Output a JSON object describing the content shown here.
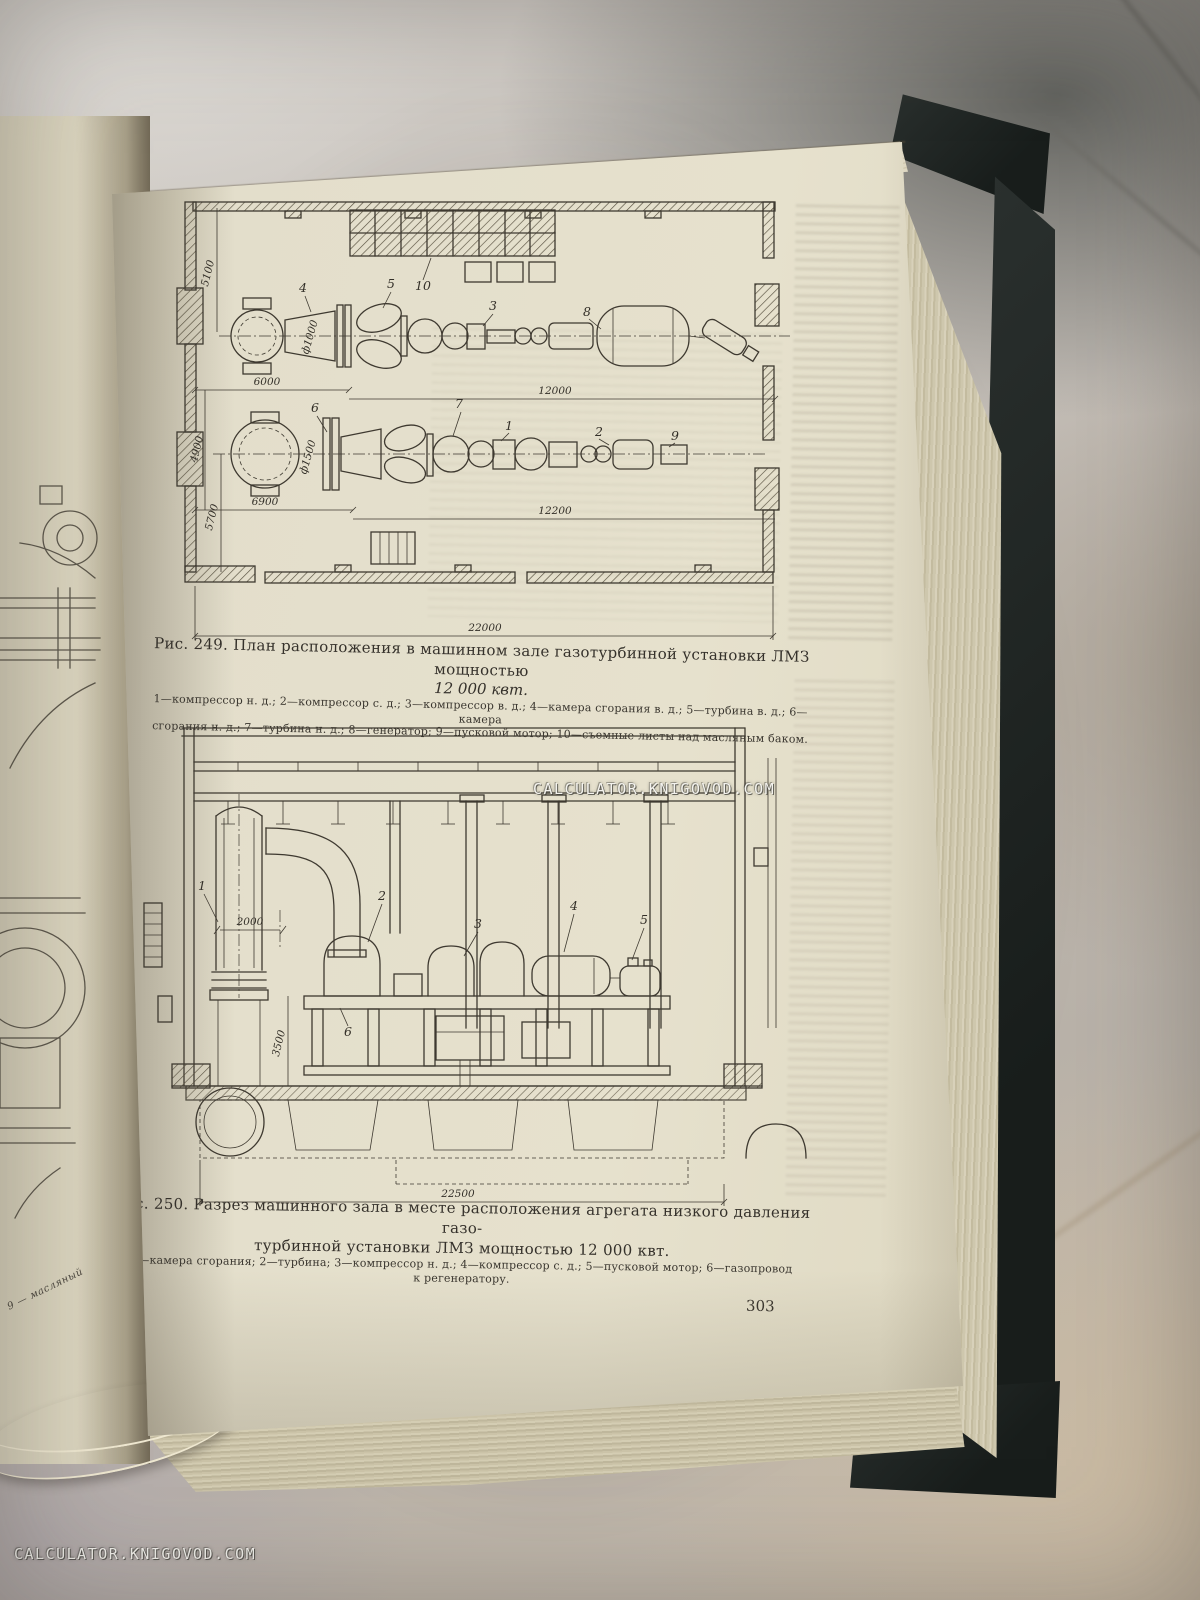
{
  "watermark": {
    "text": "CALCULATOR.KNIGOVOD.COM"
  },
  "page": {
    "number": "303"
  },
  "left_page": {
    "fragment_note": "9 — масляный"
  },
  "figure249": {
    "caption_line1": "Рис. 249. План расположения в машинном зале газотурбинной установки ЛМЗ мощностью",
    "caption_line2": "12 000 квт.",
    "legend_line1": "1—компрессор н. д.; 2—компрессор с. д.; 3—компрессор в. д.; 4—камера сгорания в. д.; 5—турбина в. д.; 6—камера",
    "legend_line2": "сгорания н. д.; 7—турбина н. д.; 8—генератор; 9—пусковой мотор; 10—съемные листы над масляным баком.",
    "dims": {
      "d5100": "5100",
      "d6000": "6000",
      "d12000": "12000",
      "d4900": "4900",
      "d6900": "6900",
      "d12200": "12200",
      "d5700": "5700",
      "d22000": "22000",
      "f1000": "ф1000",
      "f1500": "ф1500"
    },
    "items": {
      "i1": "1",
      "i2": "2",
      "i3": "3",
      "i4": "4",
      "i5": "5",
      "i6": "6",
      "i7": "7",
      "i8": "8",
      "i9": "9",
      "i10": "10"
    }
  },
  "figure250": {
    "caption_line1": "Рис. 250. Разрез машинного зала в месте расположения агрегата низкого давления газо-",
    "caption_line2": "турбинной установки ЛМЗ мощностью 12 000 квт.",
    "legend_line1": "1—камера сгорания; 2—турбина; 3—компрессор н. д.; 4—компрессор с. д.; 5—пусковой мотор; 6—газопровод",
    "legend_line2": "к регенератору.",
    "dims": {
      "d2000": "2000",
      "d3500": "3500",
      "d22500": "22500"
    },
    "items": {
      "i1": "1",
      "i2": "2",
      "i3": "3",
      "i4": "4",
      "i5": "5",
      "i6": "6"
    }
  }
}
